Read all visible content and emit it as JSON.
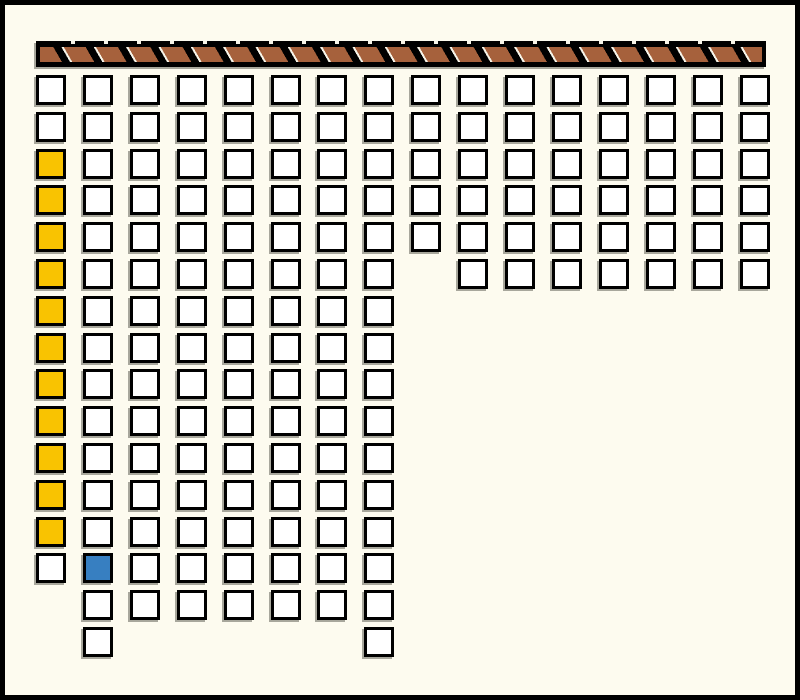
{
  "board": {
    "columns": 16,
    "rows": 16,
    "cells": [
      "wwwwwwwwwwwwwwww",
      "wwwwwwwwwwwwwwww",
      "ywwwwwwwwwwwwwww",
      "ywwwwwwwwwwwwwww",
      "ywwwwwwwwwwwwwww",
      "ywwwwwww.wwwwwww",
      "ywwwwwww........",
      "ywwwwwww........",
      "ywwwwwww........",
      "ywwwwwww........",
      "ywwwwwww........",
      "ywwwwwww........",
      "ywwwwwww........",
      "wbwwwwww........",
      ".wwwwwww........",
      ".w.....w........"
    ],
    "legend": {
      "w": "square_white",
      "y": "square_yellow",
      "b": "square_blue",
      ".": "empty"
    }
  },
  "colors": {
    "background": "#FDFBEF",
    "outline": "#000000",
    "square_white": "#FFFFFF",
    "square_yellow": "#F9C301",
    "square_blue": "#377FC1",
    "wall_brown": "#A6613C",
    "shadow_gray": "#A8A79C"
  }
}
